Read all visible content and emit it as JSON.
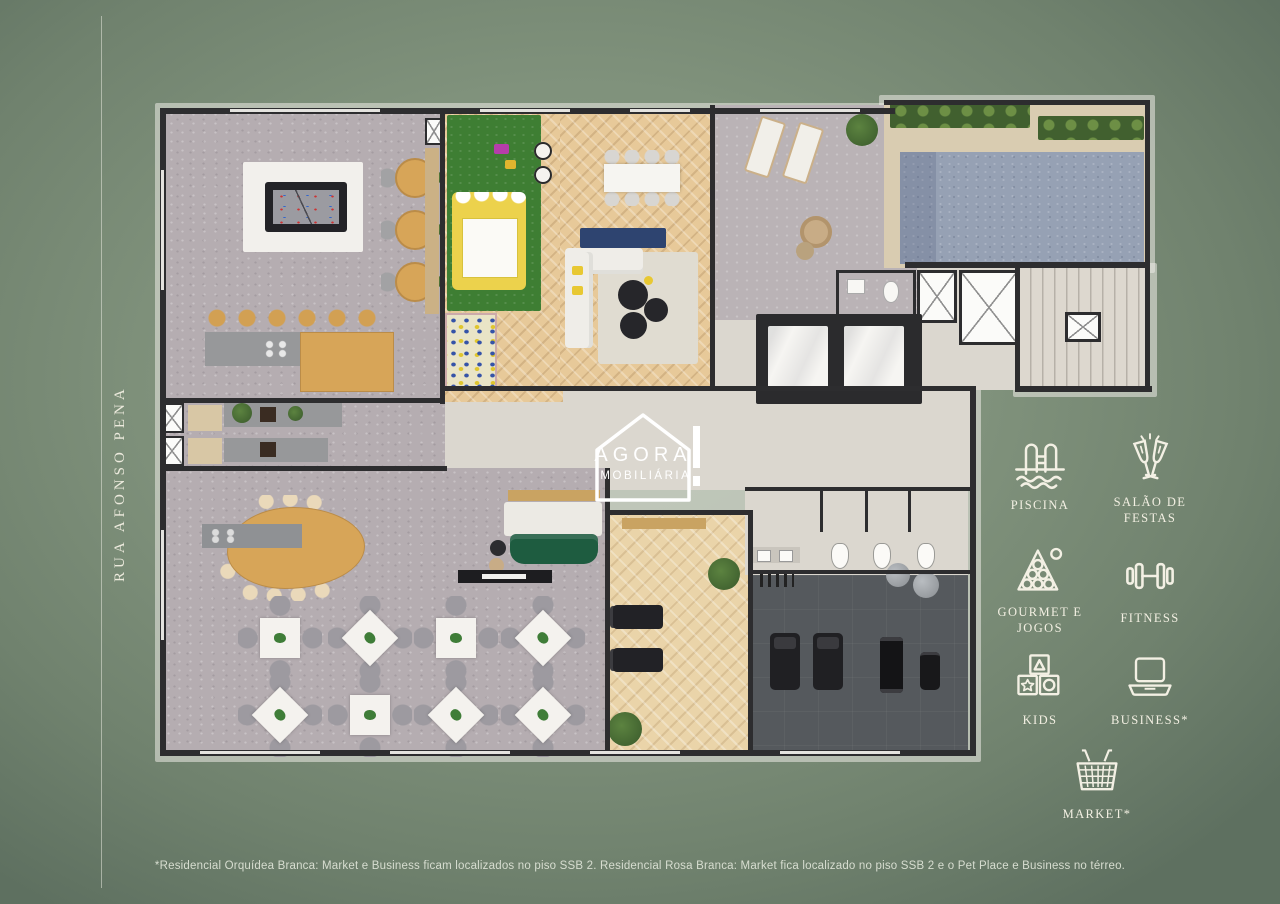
{
  "street": {
    "label": "RUA AFONSO PENA"
  },
  "logo": {
    "name": "AGORA",
    "tagline": "IMOBILIÁRIA"
  },
  "amenities": [
    {
      "icon": "pool-icon",
      "label": "PISCINA"
    },
    {
      "icon": "champagne-icon",
      "label": "SALÃO DE FESTAS"
    },
    {
      "icon": "billiards-icon",
      "label": "GOURMET E JOGOS"
    },
    {
      "icon": "dumbbell-icon",
      "label": "FITNESS"
    },
    {
      "icon": "toy-blocks-icon",
      "label": "KIDS"
    },
    {
      "icon": "laptop-icon",
      "label": "BUSINESS*"
    },
    {
      "icon": "basket-icon",
      "label": "MARKET*"
    }
  ],
  "disclaimer": "*Residencial Orquídea Branca: Market e Business ficam localizados no piso SSB 2. Residencial Rosa Branca: Market fica localizado no piso SSB 2 e o Pet Place e Business no térreo.",
  "colors": {
    "background": "#7e907b",
    "icon_white": "#f3f0e4",
    "wall": "#2d2d2f",
    "pool_water": "#96a1b4",
    "lawn_green": "#3e7e33",
    "wood": "#e7c999"
  }
}
